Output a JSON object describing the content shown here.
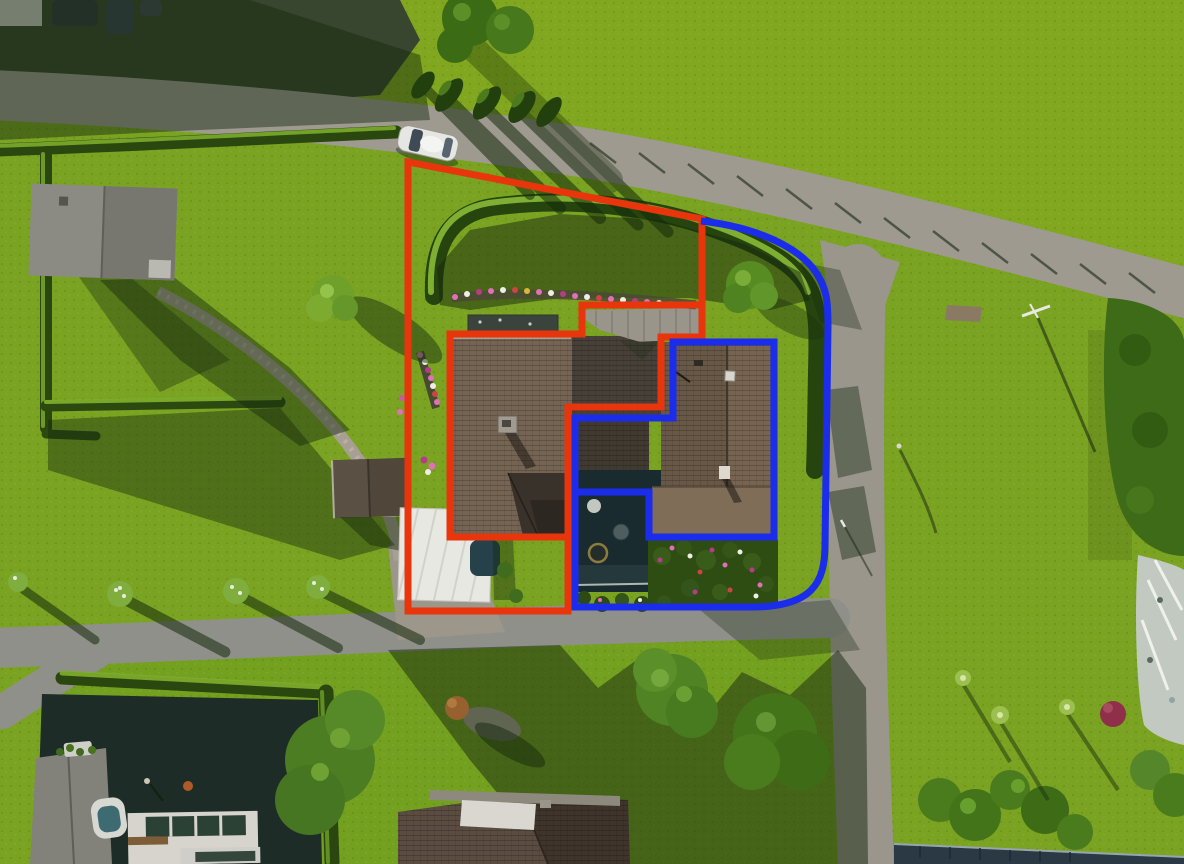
{
  "image": {
    "kind": "aerial-drone-photo-with-property-annotations",
    "width": 1184,
    "height": 864
  },
  "annotations": {
    "red_boundary": {
      "color": "#e8350c",
      "stroke_width": 7,
      "paths": [
        "M408,162 L702,219 L702,337 L661,337 L661,407 L568,407 L568,611 L408,611 Z",
        "M702,305 L582,305 L582,334 L450,334 L450,537 L568,537"
      ]
    },
    "blue_boundary": {
      "color": "#1b2ceb",
      "stroke_width": 7,
      "paths": [
        "M673,342 L774,342 L774,537 L649,537 L649,492 L575,492 L575,418 L673,418 Z",
        "M701,221 C756,227 798,247 815,271 C827,288 828,302 828,326 L825,545 C825,583 812,607 752,607 L575,607 L575,492"
      ]
    }
  },
  "palette": {
    "grass_sunlit": "#7aa322",
    "grass_field": "#80a71f",
    "grass_shadow": "#15280e",
    "hedge_dark": "#26450e",
    "hedge_light": "#8fc238",
    "road": "#9e9a90",
    "roof_left_house": "#756453",
    "roof_middle": "#474038",
    "roof_right_house": "#685847",
    "roof_gable_gray": "#99958a",
    "carport_white": "#e8e8e3",
    "pool_dark": "#1a2b30",
    "annotation_red": "#e8350c",
    "annotation_blue": "#1b2ceb"
  }
}
